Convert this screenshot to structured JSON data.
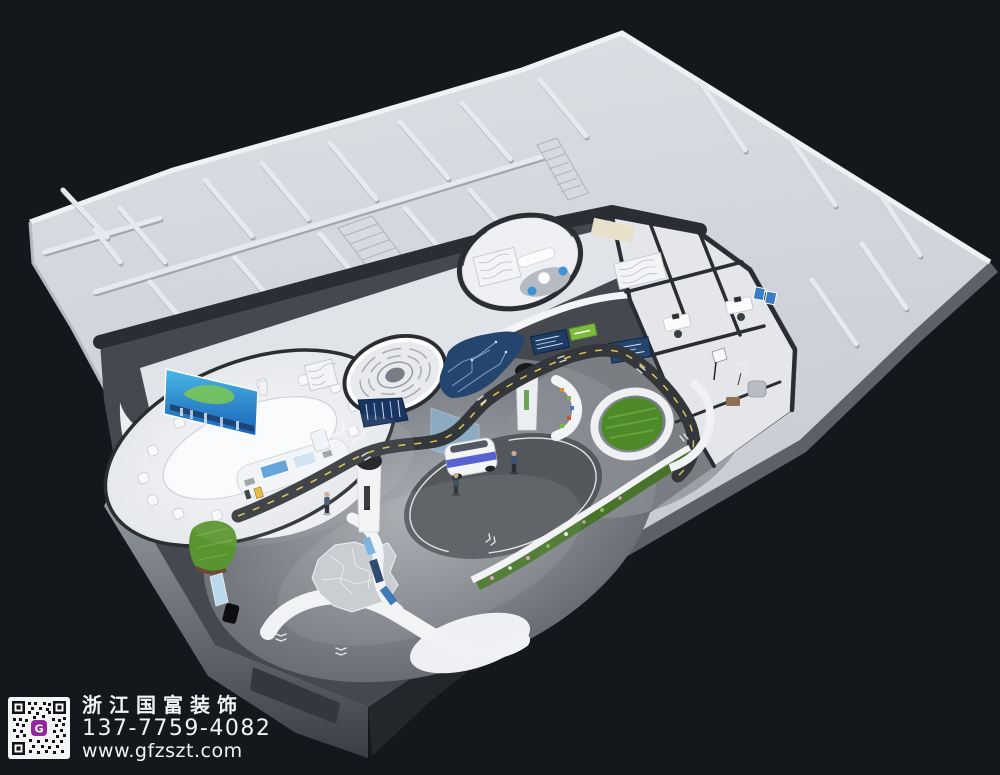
{
  "watermark": {
    "company_name": "浙江国富装饰",
    "phone": "137-7759-4082",
    "website": "www.gfzszt.com",
    "logo_letter": "G"
  },
  "colors": {
    "bg": "#14171c",
    "building-light": "#d2d5db",
    "wall-light": "#e7e9ee",
    "wall-shadow": "#a8acb4",
    "zone-dark": "#2a2d33",
    "floor-mid": "#94979d",
    "platform-white": "#eef0f4",
    "road": "#33363b",
    "road-dash": "#d9c84e",
    "navy-panel": "#1e3c66",
    "circuit-navy": "#24466e",
    "screen-cyan": "#49b8e8",
    "screen-blue": "#1565c0",
    "map-green": "#7ec850",
    "grass": "#58942f",
    "hedge": "#47732a",
    "accent-blue": "#3f92d6",
    "car-blue": "#3b49c9",
    "beige": "#e8e0ca",
    "slab-gray": "#5d6167",
    "people-navy": "#3d5272",
    "logo-purple": "#93279c",
    "text-white": "#f2f3f5"
  }
}
